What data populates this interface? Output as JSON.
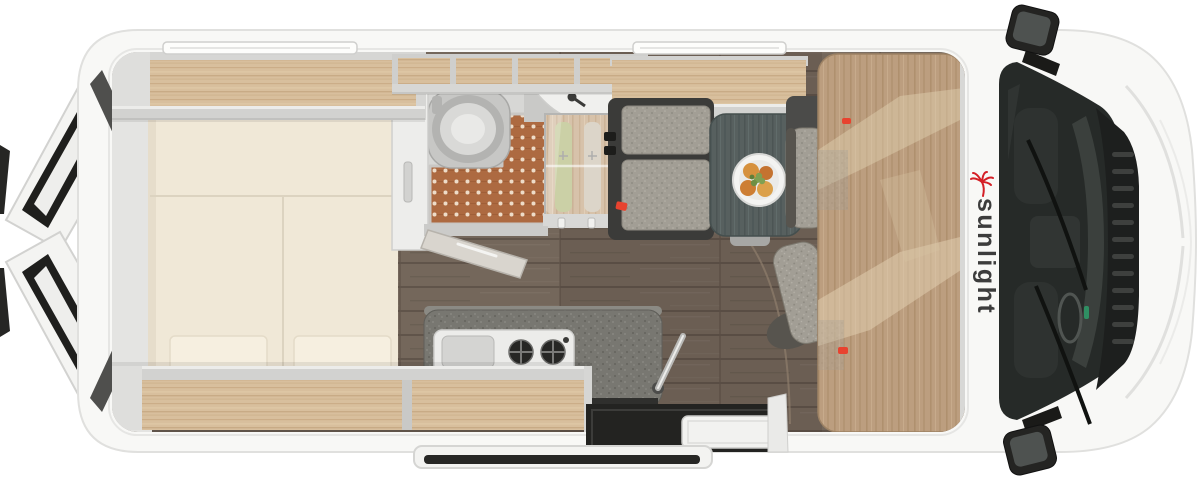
{
  "brand": {
    "logo_text": "sunlight",
    "logo_text_color": "#3c3c3c",
    "palm_icon_color": "#d41f26"
  },
  "palette": {
    "background": "#ffffff",
    "body_shell": "#f8f8f6",
    "trim_gray": "#d2d2d0",
    "floor_wood_dark": "#74675b",
    "cabinet_wood_light": "#d8bf9d",
    "cab_panel_wood": "#bc9e7f",
    "mattress_cream": "#f0e8d7",
    "pillow_cream": "#f6efe0",
    "shower_mat_copper": "#ad6a41",
    "counter_granite": "#787771",
    "table_top": "#57605f",
    "upholstery_speckle": "#a29e95",
    "glass_dark": "#262a28",
    "accent_red": "#e8432f"
  },
  "features": [
    "rear-double-bed",
    "pillows",
    "overhead-storage-shelves",
    "bathroom-with-shower",
    "toilet",
    "corner-washbasin",
    "wardrobe-with-clothes",
    "kitchen-sink-and-stove",
    "dinette-bench",
    "dinette-table",
    "food-plate",
    "cab-swivel-seats",
    "cab-roof-panel",
    "open-rear-doors",
    "open-sliding-door",
    "entry-step",
    "side-mirrors",
    "windshield-wipers",
    "roof-skylights"
  ]
}
